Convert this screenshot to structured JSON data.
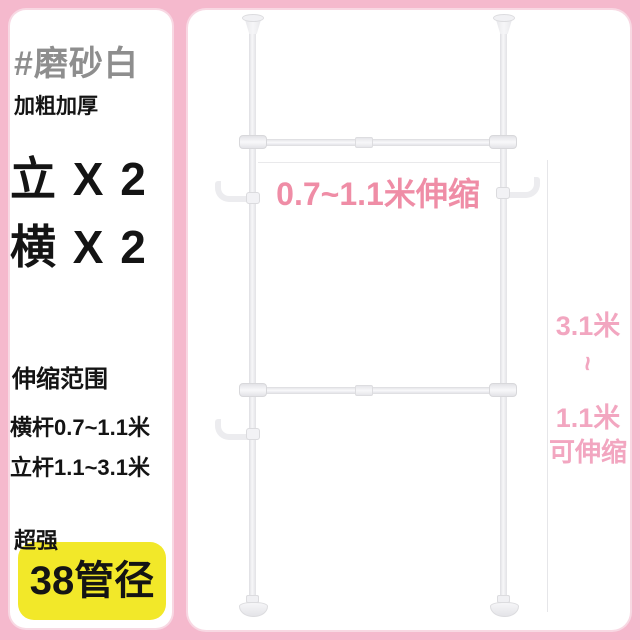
{
  "left_card": {
    "variant_tag": "#磨砂白",
    "feature_label": "加粗加厚",
    "vertical_count": "立 X 2",
    "horizontal_count": "横 X 2",
    "range_section": {
      "title": "伸缩范围",
      "horizontal_bar_range": "横杆0.7~1.1米",
      "vertical_pole_range": "立杆1.1~3.1米"
    },
    "strength_label": "超强",
    "diameter_badge": "38管径"
  },
  "diagram": {
    "bar_range_annotation": "0.7~1.1米伸缩",
    "side_annotation": {
      "max_height": "3.1米",
      "tilde": "~",
      "min_height": "1.1米",
      "suffix": "可伸缩"
    }
  },
  "colors": {
    "frame_pink": "#f5b9cd",
    "annotation_pink": "#ef8da6",
    "side_text_pink": "#f2a6c0",
    "variant_gray": "#8e8e8e",
    "badge_yellow": "#f2e829",
    "text_black": "#141414"
  }
}
